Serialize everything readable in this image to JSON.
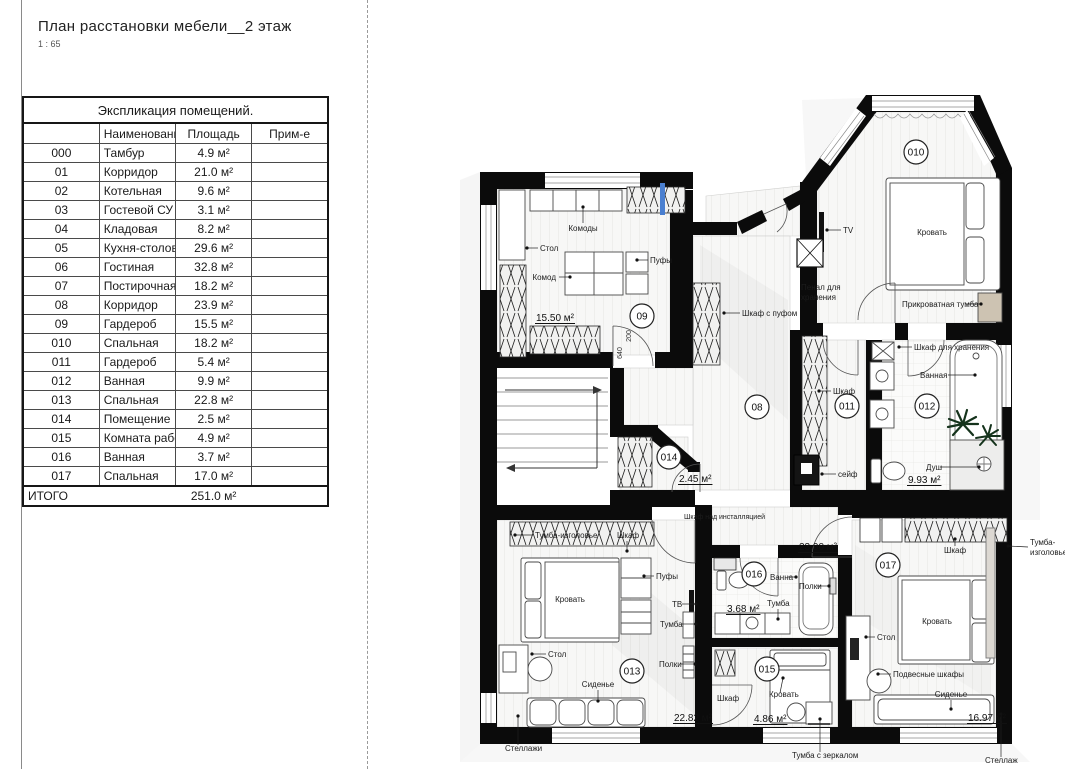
{
  "page": {
    "title": "План расстановки мебели__2 этаж",
    "scale": "1 : 65"
  },
  "table": {
    "title": "Экспликация помещений.",
    "headers": {
      "num": "",
      "name": "Наименование",
      "area": "Площадь",
      "note": "Прим-е"
    },
    "rows": [
      [
        "000",
        "Тамбур",
        "4.9 м²"
      ],
      [
        "01",
        "Корридор",
        "21.0 м²"
      ],
      [
        "02",
        "Котельная",
        "9.6 м²"
      ],
      [
        "03",
        "Гостевой СУ",
        "3.1 м²"
      ],
      [
        "04",
        "Кладовая",
        "8.2 м²"
      ],
      [
        "05",
        "Кухня-столовая",
        "29.6 м²"
      ],
      [
        "06",
        "Гостиная",
        "32.8 м²"
      ],
      [
        "07",
        "Постирочная",
        "18.2 м²"
      ],
      [
        "08",
        "Корридор",
        "23.9 м²"
      ],
      [
        "09",
        "Гардероб",
        "15.5 м²"
      ],
      [
        "010",
        "Спальная",
        "18.2 м²"
      ],
      [
        "011",
        "Гардероб",
        "5.4 м²"
      ],
      [
        "012",
        "Ванная",
        "9.9 м²"
      ],
      [
        "013",
        "Спальная",
        "22.8 м²"
      ],
      [
        "014",
        "Помещение",
        "2.5 м²"
      ],
      [
        "015",
        "Комната работника",
        "4.9 м²"
      ],
      [
        "016",
        "Ванная",
        "3.7 м²"
      ],
      [
        "017",
        "Спальная",
        "17.0 м²"
      ]
    ],
    "total_label": "ИТОГО",
    "total_area": "251.0 м²"
  },
  "plan": {
    "colors": {
      "walls": "#0b0b0b",
      "accent_blue": "#4a7fd0",
      "wood": "#cdc3b2",
      "plant_green": "#15331c"
    },
    "rooms": [
      {
        "num": "09",
        "x": 642,
        "y": 316
      },
      {
        "num": "010",
        "x": 916,
        "y": 152
      },
      {
        "num": "08",
        "x": 757,
        "y": 407
      },
      {
        "num": "011",
        "x": 847,
        "y": 406
      },
      {
        "num": "012",
        "x": 927,
        "y": 406
      },
      {
        "num": "014",
        "x": 669,
        "y": 457
      },
      {
        "num": "013",
        "x": 632,
        "y": 671
      },
      {
        "num": "016",
        "x": 754,
        "y": 574
      },
      {
        "num": "015",
        "x": 767,
        "y": 669
      },
      {
        "num": "017",
        "x": 888,
        "y": 565
      }
    ],
    "areas": [
      {
        "text": "15.50 м²",
        "x": 536,
        "y": 321
      },
      {
        "text": "9.93 м²",
        "x": 908,
        "y": 483
      },
      {
        "text": "2.45 м²",
        "x": 679,
        "y": 482
      },
      {
        "text": "23.90 м²",
        "x": 799,
        "y": 550
      },
      {
        "text": "3.68 м²",
        "x": 727,
        "y": 612
      },
      {
        "text": "22.82 м²",
        "x": 674,
        "y": 721
      },
      {
        "text": "4.86 м²",
        "x": 754,
        "y": 722
      },
      {
        "text": "16.97 м²",
        "x": 968,
        "y": 721
      }
    ],
    "dims": [
      {
        "text": "640",
        "x": 622,
        "y": 353,
        "rot": -90
      },
      {
        "text": "200",
        "x": 631,
        "y": 336,
        "rot": -90
      }
    ],
    "labels": [
      {
        "text": "Комоды",
        "x": 583,
        "y": 231,
        "anchor": "middle",
        "leader": [
          583,
          223,
          583,
          207
        ]
      },
      {
        "text": "Стол",
        "x": 540,
        "y": 251,
        "anchor": "start",
        "leader": [
          538,
          248,
          527,
          248
        ]
      },
      {
        "text": "Комод",
        "x": 556,
        "y": 280,
        "anchor": "end",
        "leader": [
          559,
          277,
          570,
          277
        ]
      },
      {
        "text": "Пуфы",
        "x": 650,
        "y": 263,
        "anchor": "start",
        "leader": [
          648,
          260,
          637,
          260
        ]
      },
      {
        "text": "TV",
        "x": 843,
        "y": 233,
        "anchor": "start",
        "leader": [
          841,
          230,
          827,
          230
        ]
      },
      {
        "text": "Кровать",
        "x": 932,
        "y": 235,
        "anchor": "middle"
      },
      {
        "text": "Пенал для",
        "x": 801,
        "y": 290,
        "anchor": "start"
      },
      {
        "text": "хранения",
        "x": 801,
        "y": 300,
        "anchor": "start"
      },
      {
        "text": "Прикроватная тумба",
        "x": 902,
        "y": 307,
        "anchor": "start",
        "leader": [
          966,
          304,
          981,
          304
        ]
      },
      {
        "text": "Шкаф с пуфом",
        "x": 742,
        "y": 316,
        "anchor": "start",
        "leader": [
          740,
          313,
          724,
          313
        ]
      },
      {
        "text": "Шкаф для хранения",
        "x": 914,
        "y": 350,
        "anchor": "start",
        "leader": [
          912,
          347,
          899,
          347
        ]
      },
      {
        "text": "Ванная",
        "x": 920,
        "y": 378,
        "anchor": "start",
        "leader": [
          948,
          375,
          975,
          375
        ]
      },
      {
        "text": "Шкаф",
        "x": 833,
        "y": 394,
        "anchor": "start",
        "leader": [
          831,
          391,
          819,
          391
        ]
      },
      {
        "text": "сейф",
        "x": 838,
        "y": 477,
        "anchor": "start",
        "leader": [
          836,
          474,
          822,
          474
        ]
      },
      {
        "text": "Душ",
        "x": 926,
        "y": 470,
        "anchor": "start",
        "leader": [
          940,
          467,
          979,
          467
        ]
      },
      {
        "text": "Шкаф над инсталляцией",
        "x": 684,
        "y": 519,
        "anchor": "start",
        "size": 7
      },
      {
        "text": "Тумба-изголовье",
        "x": 535,
        "y": 538,
        "anchor": "start",
        "leader": [
          533,
          535,
          515,
          535
        ]
      },
      {
        "text": "Шкаф",
        "x": 617,
        "y": 538,
        "anchor": "start",
        "leader": [
          627,
          541,
          627,
          551
        ]
      },
      {
        "text": "Кровать",
        "x": 570,
        "y": 602,
        "anchor": "middle"
      },
      {
        "text": "Пуфы",
        "x": 656,
        "y": 579,
        "anchor": "start",
        "leader": [
          654,
          576,
          644,
          576
        ]
      },
      {
        "text": "ТВ",
        "x": 672,
        "y": 607,
        "anchor": "start",
        "leader": [
          682,
          604,
          696,
          604
        ]
      },
      {
        "text": "Тумба",
        "x": 660,
        "y": 627,
        "anchor": "start",
        "leader": [
          682,
          624,
          696,
          624
        ]
      },
      {
        "text": "Полки",
        "x": 659,
        "y": 667,
        "anchor": "start",
        "leader": [
          681,
          664,
          695,
          664
        ]
      },
      {
        "text": "Стол",
        "x": 548,
        "y": 657,
        "anchor": "start",
        "leader": [
          546,
          654,
          532,
          654
        ]
      },
      {
        "text": "Сиденье",
        "x": 598,
        "y": 687,
        "anchor": "middle",
        "leader": [
          598,
          690,
          598,
          701
        ]
      },
      {
        "text": "Ванна",
        "x": 770,
        "y": 580,
        "anchor": "start",
        "leader": [
          788,
          577,
          796,
          577
        ]
      },
      {
        "text": "Полки",
        "x": 799,
        "y": 589,
        "anchor": "start",
        "leader": [
          817,
          586,
          829,
          586
        ]
      },
      {
        "text": "Тумба",
        "x": 767,
        "y": 606,
        "anchor": "start",
        "leader": [
          778,
          609,
          778,
          619
        ]
      },
      {
        "text": "Шкаф",
        "x": 717,
        "y": 701,
        "anchor": "start"
      },
      {
        "text": "Кровать",
        "x": 769,
        "y": 697,
        "anchor": "start",
        "leader": [
          780,
          693,
          783,
          678
        ]
      },
      {
        "text": "Тумба с зеркалом",
        "x": 792,
        "y": 758,
        "anchor": "start",
        "leader": [
          820,
          752,
          820,
          719
        ]
      },
      {
        "text": "Стеллажи",
        "x": 505,
        "y": 751,
        "anchor": "start",
        "leader": [
          518,
          745,
          518,
          716
        ]
      },
      {
        "text": "Стеллаж",
        "x": 985,
        "y": 763,
        "anchor": "start",
        "leader": [
          1001,
          757,
          1001,
          714
        ]
      },
      {
        "text": "Стол",
        "x": 877,
        "y": 640,
        "anchor": "start",
        "leader": [
          875,
          637,
          866,
          637
        ]
      },
      {
        "text": "Подвесные шкафы",
        "x": 893,
        "y": 677,
        "anchor": "start",
        "leader": [
          891,
          674,
          878,
          674
        ]
      },
      {
        "text": "Сиденье",
        "x": 951,
        "y": 697,
        "anchor": "middle",
        "leader": [
          951,
          700,
          951,
          709
        ]
      },
      {
        "text": "Шкаф",
        "x": 944,
        "y": 553,
        "anchor": "start",
        "leader": [
          955,
          546,
          955,
          539
        ]
      },
      {
        "text": "Тумба-",
        "x": 1030,
        "y": 545,
        "anchor": "start",
        "leader": [
          1028,
          547,
          1008,
          546
        ]
      },
      {
        "text": "изголовье",
        "x": 1030,
        "y": 555,
        "anchor": "start"
      },
      {
        "text": "Кровать",
        "x": 937,
        "y": 624,
        "anchor": "middle"
      }
    ]
  }
}
